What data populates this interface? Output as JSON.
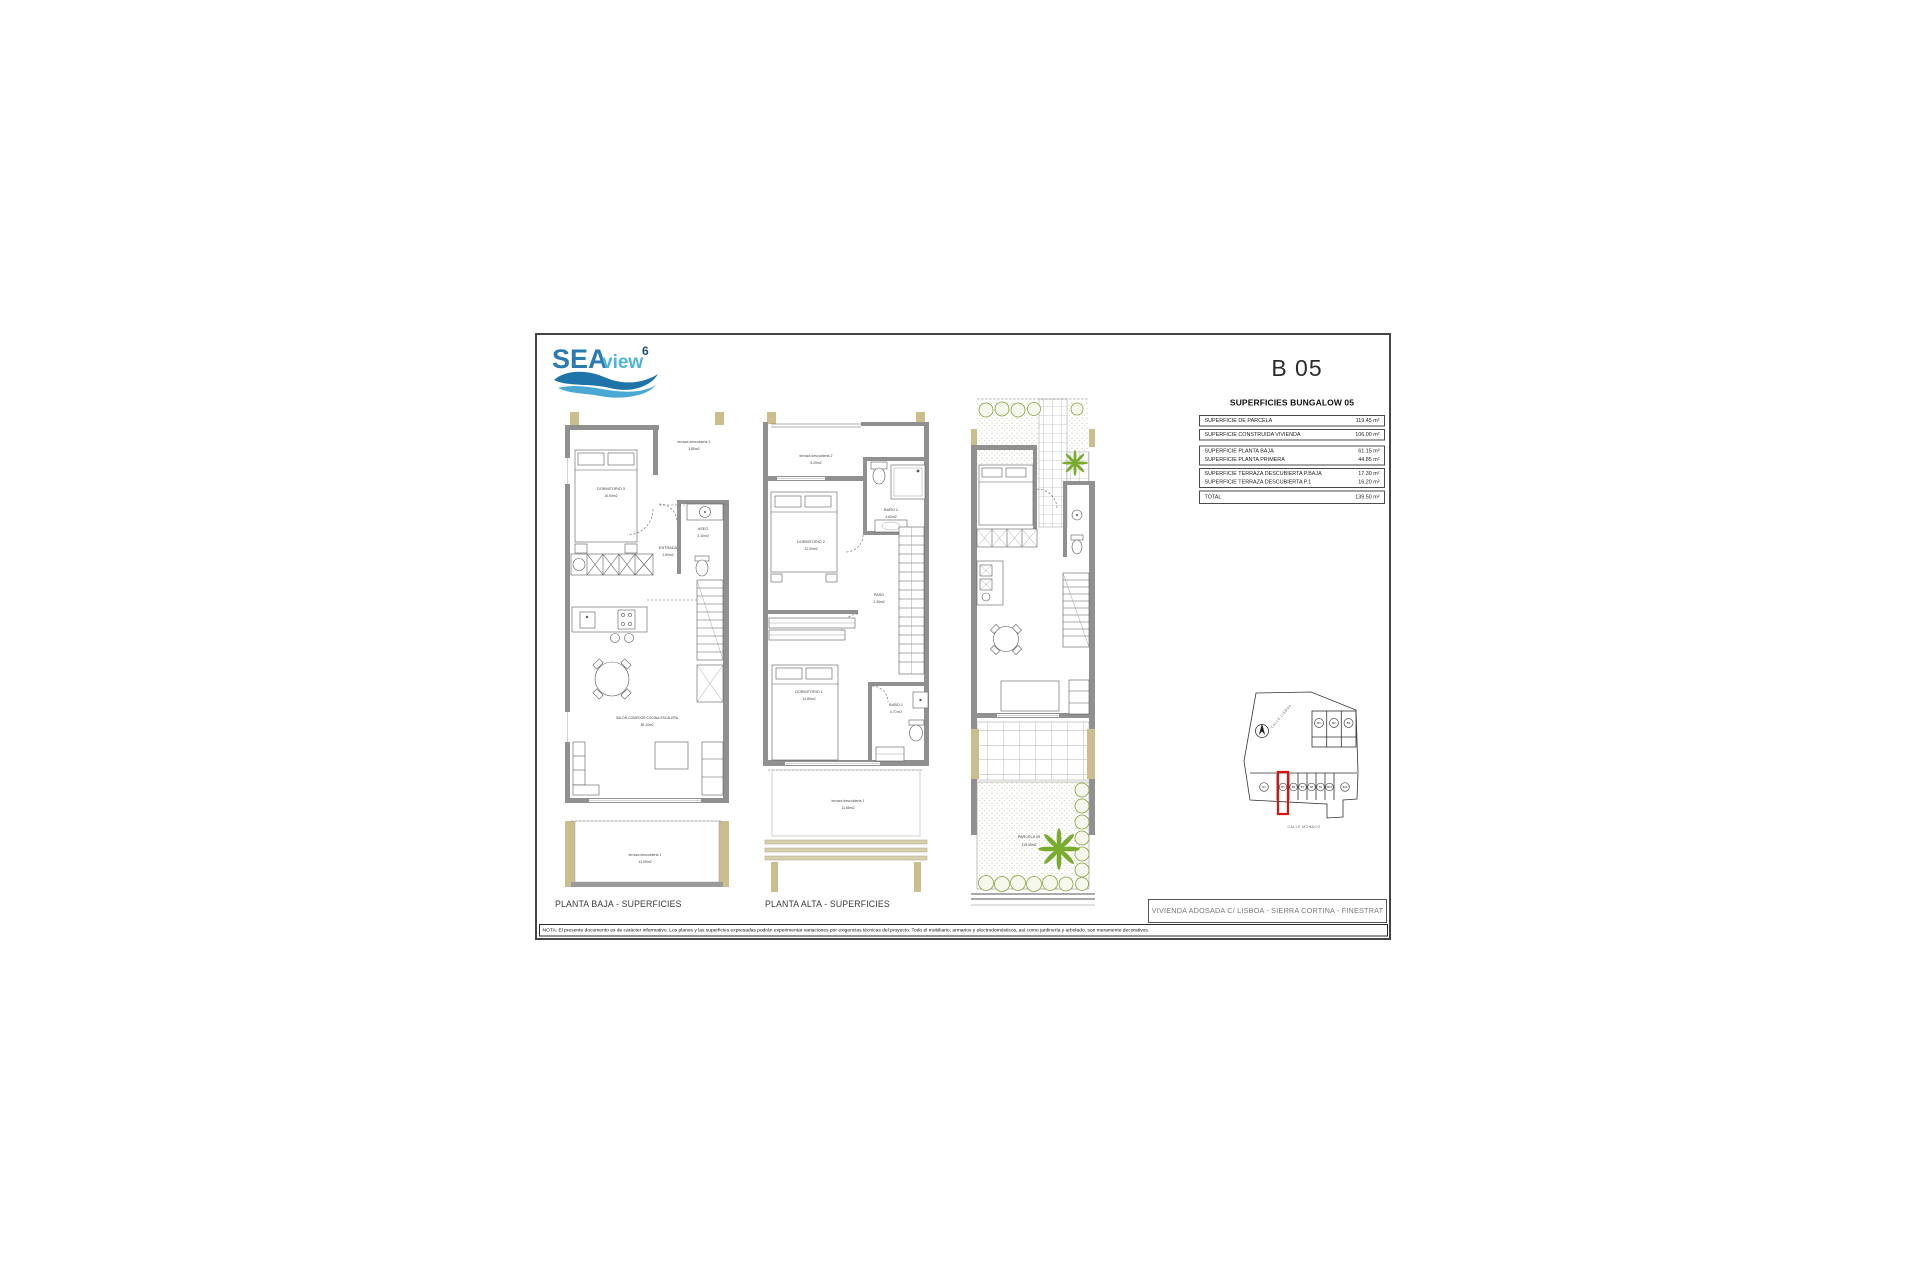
{
  "header": {
    "logo": {
      "part1": "SEA",
      "part2": "view",
      "sup": "6"
    },
    "unit_code": "B 05"
  },
  "areas": {
    "heading": "SUPERFICIES BUNGALOW 05",
    "groups": [
      {
        "rows": [
          {
            "label": "SUPERFICIE DE PARCELA",
            "value": "119.45 m²"
          }
        ]
      },
      {
        "rows": [
          {
            "label": "SUPERFICIE CONSTRUIDA VIVIENDA",
            "value": "106.00 m²"
          }
        ]
      },
      {
        "rows": [
          {
            "label": "SUPERFICIE PLANTA BAJA",
            "value": "61.15 m²"
          },
          {
            "label": "SUPERFICIE PLANTA PRIMERA",
            "value": "44.85 m²"
          }
        ]
      },
      {
        "rows": [
          {
            "label": "SUPERFICIE TERRAZA DESCUBIERTA P.BAJA",
            "value": "17.30 m²"
          },
          {
            "label": "SUPERFICIE TERRAZA DESCUBIERTA P.1",
            "value": "16.20 m²"
          }
        ]
      },
      {
        "rows": [
          {
            "label": "TOTAL",
            "value": "139.50 m²"
          }
        ]
      }
    ]
  },
  "plans": {
    "baja": {
      "title": "PLANTA BAJA - SUPERFICIES",
      "labels": {
        "dormitorio3": {
          "name": "DORMITORIO 3",
          "area": "10.00m2"
        },
        "terraza2": {
          "name": "terraza descubierta 2",
          "area": "3.80m2"
        },
        "aseo": {
          "name": "ASEO",
          "area": "3.10m2"
        },
        "entrada": {
          "name": "ENTRADA",
          "area": "2.60m2"
        },
        "salon": {
          "name": "SALÓN-COMEDOR-COCINA-ESCALERA",
          "area": "38.10m2"
        },
        "terraza1": {
          "name": "terraza descubierta 1",
          "area": "13.90m2"
        }
      }
    },
    "alta": {
      "title": "PLANTA ALTA - SUPERFICIES",
      "labels": {
        "terraza2": {
          "name": "terraza descubierta 2",
          "area": "5.20m2"
        },
        "banyo2": {
          "name": "BAÑO 2",
          "area": "4.60m2"
        },
        "dormitorio2": {
          "name": "DORMITORIO 2",
          "area": "12.00m2"
        },
        "paso": {
          "name": "PASO",
          "area": "2.30m2"
        },
        "dormitorio1": {
          "name": "DORMITORIO 1",
          "area": "14.80m2"
        },
        "banyo1": {
          "name": "BAÑO 1",
          "area": "4.70 m2"
        },
        "terraza1": {
          "name": "terraza descubierta 1",
          "area": "11.55m2"
        }
      }
    },
    "parcela": {
      "labels": {
        "parcela": {
          "name": "PARCELA 05",
          "area": "119.45m2"
        }
      }
    }
  },
  "site_plan": {
    "street_top": "CALLE LISBOA",
    "street_bottom": "CALLE MÓNACO",
    "units_top": [
      "B1",
      "B2",
      "B3"
    ],
    "units_bottom": [
      "B4",
      "B5",
      "B6",
      "B7",
      "B8",
      "B9",
      "B10",
      "B11"
    ],
    "highlighted_unit": "B5",
    "north_icon": "north-arrow"
  },
  "title_block": {
    "text": "VIVIENDA ADOSADA C/ LISBOA - SIERRA CORTINA - FINESTRAT"
  },
  "nota": {
    "text": "NOTA: El presente documento es de carácter informativo. Los planos y las superficies expresadas podrán experimentar variaciones por exigencias técnicas del proyecto. Todo el mobiliario, armarios y electrodomésticos, así como jardinería y arbolado, son meramente decorativos."
  },
  "palette": {
    "logo_blue_dark": "#2a7cb0",
    "logo_blue_light": "#4fb4dc",
    "logo_navy": "#1c4f74",
    "wall_gray": "#909090",
    "pillar_tan": "#cbbd8c",
    "vegetation_green": "#79ab2f",
    "highlight_red": "#dd1111"
  }
}
